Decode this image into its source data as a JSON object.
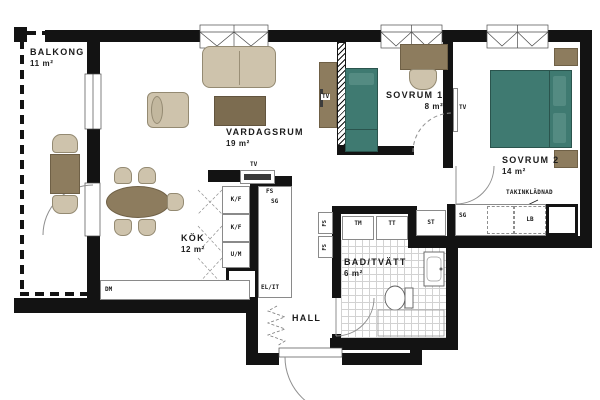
{
  "rooms": {
    "balkong": {
      "name": "BALKONG",
      "area": "11 m²"
    },
    "vardagsrum": {
      "name": "VARDAGSRUM",
      "area": "19 m²"
    },
    "sovrum1": {
      "name": "SOVRUM 1",
      "area": "8 m²"
    },
    "sovrum2": {
      "name": "SOVRUM 2",
      "area": "14 m²"
    },
    "kok": {
      "name": "KÖK",
      "area": "12 m²"
    },
    "bad": {
      "name": "BAD/TVÄTT",
      "area": "6 m²"
    },
    "hall": {
      "name": "HALL",
      "area": ""
    }
  },
  "fixtures": {
    "tv_livingroom": "TV",
    "tv_wall_unit": "TV",
    "tv_sovrum2": "TV",
    "fridge_freezer_1": "K/F",
    "fridge_freezer_2": "K/F",
    "oven_micro": "U/M",
    "fs_kitchen": "FS",
    "sg_kitchen": "SG",
    "el_it": "EL/IT",
    "dishwasher": "DM",
    "washer": "TM",
    "dryer": "TT",
    "fs_hall_upper": "FS",
    "fs_hall_lower": "FS",
    "st_closet": "ST",
    "sg_wardrobe": "SG",
    "lb_closet": "LB",
    "ceiling_note": "TAKINKLÄDNAD"
  },
  "colors": {
    "wall": "#131313",
    "wood_dark": "#7c6c50",
    "wood_mid": "#8d7c5e",
    "upholstery": "#cec3ac",
    "bed": "#3f7a71"
  }
}
